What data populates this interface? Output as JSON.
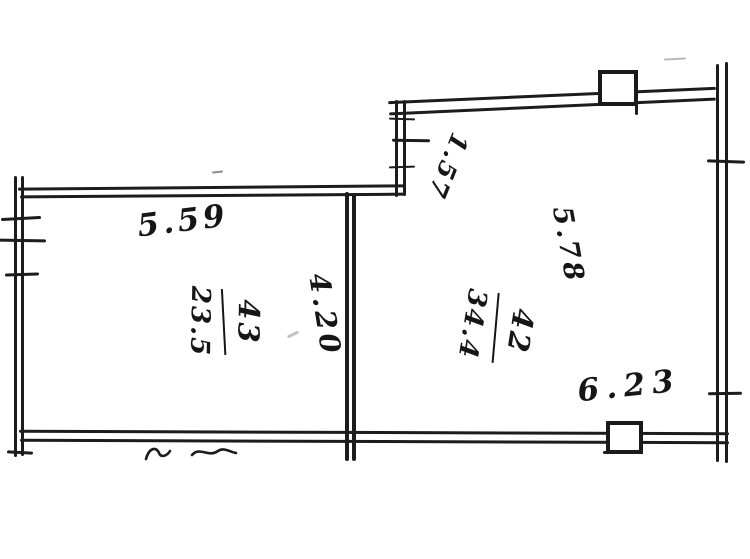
{
  "colors": {
    "ink": "#1c1c1c",
    "paper": "#ffffff"
  },
  "floor_plan": {
    "rooms": [
      {
        "number": "43",
        "area": "23.5"
      },
      {
        "number": "42",
        "area": "34.4"
      }
    ],
    "dimensions": {
      "top_left_width": "5.59",
      "step_depth": "1.57",
      "middle_wall_height": "4.20",
      "right_wall_height": "5.78",
      "bottom_width": "6.23"
    }
  }
}
